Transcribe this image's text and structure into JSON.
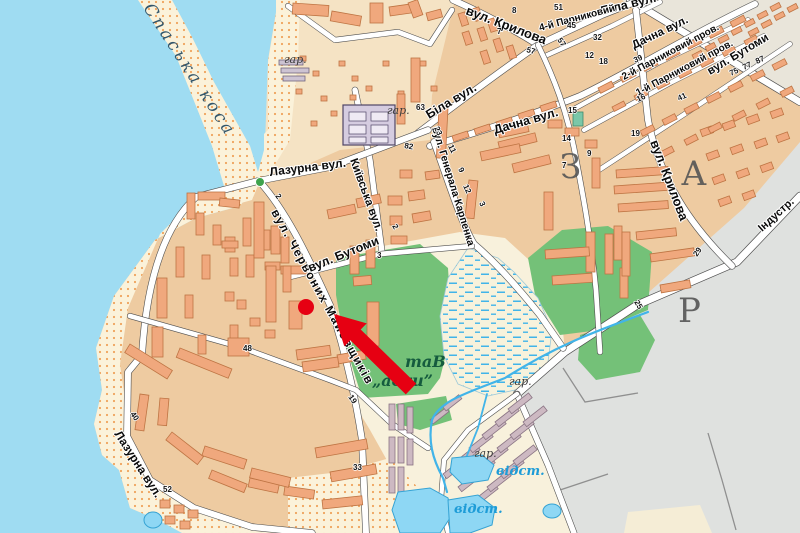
{
  "map": {
    "spit_name": "Спаська коса",
    "streets": {
      "krylova_top": "вул. Крилова",
      "krylova_right": "вул. Крилова",
      "bila_mid": "Біла вул.",
      "bila_ne": "Біла вул.",
      "dachna_mid": "Дачна вул.",
      "dachna_ne": "Дачна вул.",
      "lazurna_top": "Лазурна вул.",
      "lazurna_sw": "Лазурна вул.",
      "kyivska": "Київська вул.",
      "chervonykh": "вул. Червоних Майовщиків",
      "butomy_mid": "вул. Бутоми",
      "butomy_ne": "вул. Бутоми",
      "karpenka": "вул. Генерала Карпенка",
      "park4": "4-й Парниковий",
      "park2": "2-й Парниковий пров.",
      "park1": "1-й Парниковий пров.",
      "industrialna": "Індустр."
    },
    "labels": {
      "garage": "гар.",
      "basin": "відст.",
      "pond_line1": "таВ",
      "pond_line2": "„аски”"
    },
    "region_letters": {
      "z": "З",
      "a": "А",
      "r": "Р"
    },
    "numbers": [
      "8",
      "7",
      "57",
      "51",
      "57",
      "45",
      "32",
      "12",
      "18",
      "39",
      "16",
      "41",
      "75",
      "77",
      "87",
      "63",
      "82",
      "23",
      "11",
      "9",
      "3",
      "14",
      "9",
      "7",
      "15",
      "19",
      "25",
      "29",
      "2",
      "3",
      "2",
      "48",
      "40",
      "52",
      "33",
      "19",
      "12"
    ],
    "colors": {
      "water": "#9FDCF2",
      "land": "#EECBA1",
      "sand": "#FBF2DA",
      "green": "#74C178",
      "road": "#FFFFFF",
      "building": "#F0A87D",
      "industrial": "#DFE1DF",
      "marker": "#E60012",
      "stream": "#41B4E9"
    }
  }
}
